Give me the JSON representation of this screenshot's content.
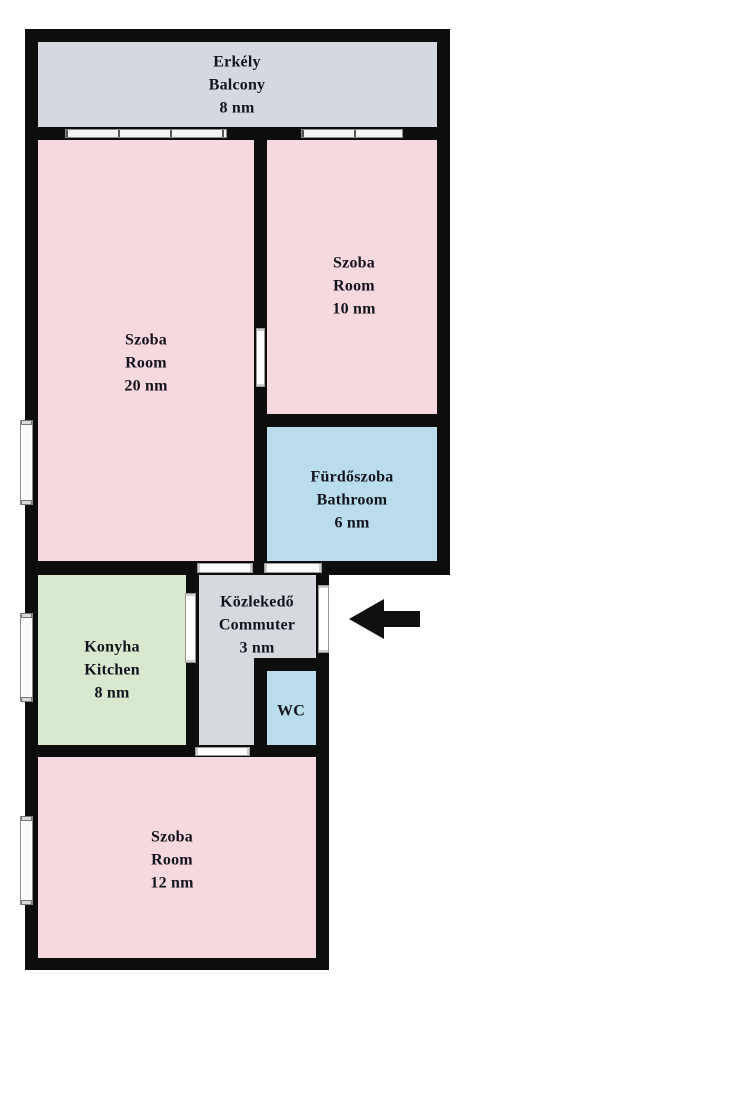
{
  "floorplan": {
    "type": "apartment-floor-plan",
    "area_unit": "nm",
    "rooms": {
      "balcony": {
        "name_hu": "Erkély",
        "name_en": "Balcony",
        "area": "8 nm"
      },
      "room20": {
        "name_hu": "Szoba",
        "name_en": "Room",
        "area": "20 nm"
      },
      "room10": {
        "name_hu": "Szoba",
        "name_en": "Room",
        "area": "10 nm"
      },
      "bathroom": {
        "name_hu": "Fürdőszoba",
        "name_en": "Bathroom",
        "area": "6 nm"
      },
      "commuter": {
        "name_hu": "Közlekedő",
        "name_en": "Commuter",
        "area": "3 nm"
      },
      "kitchen": {
        "name_hu": "Konyha",
        "name_en": "Kitchen",
        "area": "8 nm"
      },
      "wc": {
        "name_hu": "WC"
      },
      "room12": {
        "name_hu": "Szoba",
        "name_en": "Room",
        "area": "12 nm"
      }
    },
    "entrance": {
      "icon": "left-arrow"
    },
    "colors": {
      "wall": "#0d0d0d",
      "room_pink": "#f6d9df",
      "balcony_gray": "#d4d9e0",
      "hall_gray": "#d6dade",
      "water_blue": "#b9ddec",
      "kitchen_green": "#d8e9d0",
      "opening_white": "#ffffff",
      "label_text": "#14141e",
      "arrow_black": "#101010"
    }
  }
}
